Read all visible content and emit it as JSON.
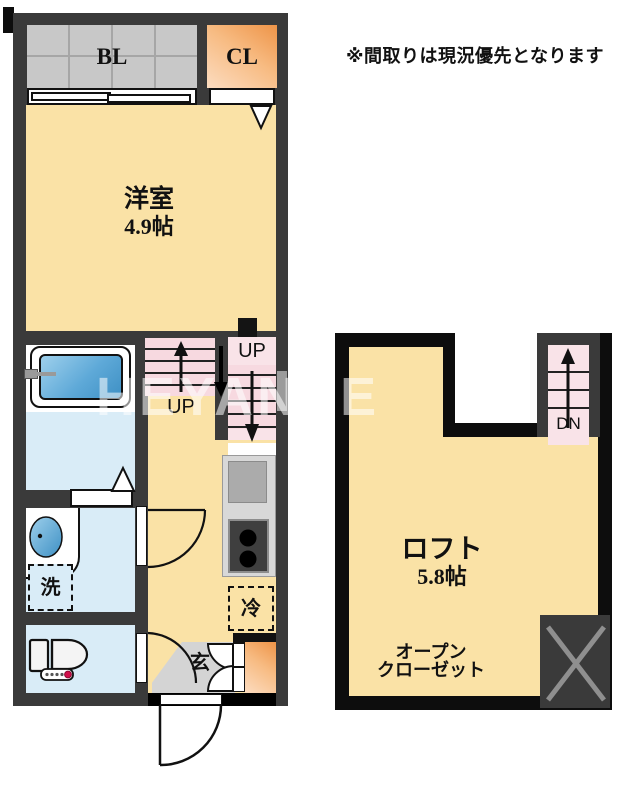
{
  "disclaimer": "※間取りは現況優先となります",
  "watermark": "HEYANSE",
  "palette": {
    "wall_gray": "#3a3a3a",
    "wall_black": "#0d0d0d",
    "floor_cream": "#fae2a6",
    "wet_area_blue": "#d9ecf7",
    "stairs_pink": "#f7d9e0",
    "balcony_gray": "#c8c8c8",
    "closet_orange": "#ee9448",
    "genkan_gray": "#d4d4d4",
    "tub_blue": "#4697cb"
  },
  "floor_plan": {
    "first_floor": {
      "balcony": "BL",
      "closet": "CL",
      "room": "洋室",
      "room_size": "4.9帖",
      "stair_label_lower": "UP",
      "stair_label_upper": "UP",
      "washer": "洗",
      "fridge": "冷",
      "entrance": "玄"
    },
    "loft_floor": {
      "room": "ロフト",
      "room_size": "5.8帖",
      "closet_line1": "オープン",
      "closet_line2": "クローゼット",
      "stair_label": "DN"
    }
  }
}
